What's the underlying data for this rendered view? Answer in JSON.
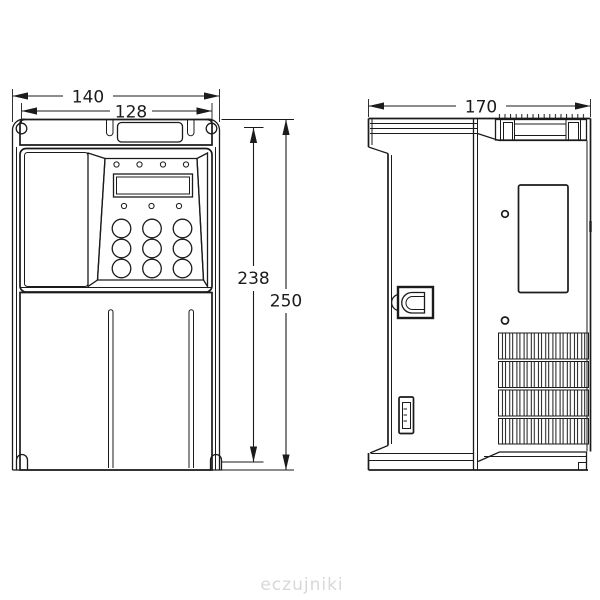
{
  "drawing": {
    "dimensions": {
      "front_overall_width_mm": "140",
      "mounting_width_mm": "128",
      "mounting_height_mm": "238",
      "front_overall_height_mm": "250",
      "side_depth_mm": "170"
    },
    "watermark": "eczujniki",
    "colors": {
      "line": "#1b1b1b",
      "background": "#ffffff",
      "watermark": "#d8d8d8"
    }
  }
}
